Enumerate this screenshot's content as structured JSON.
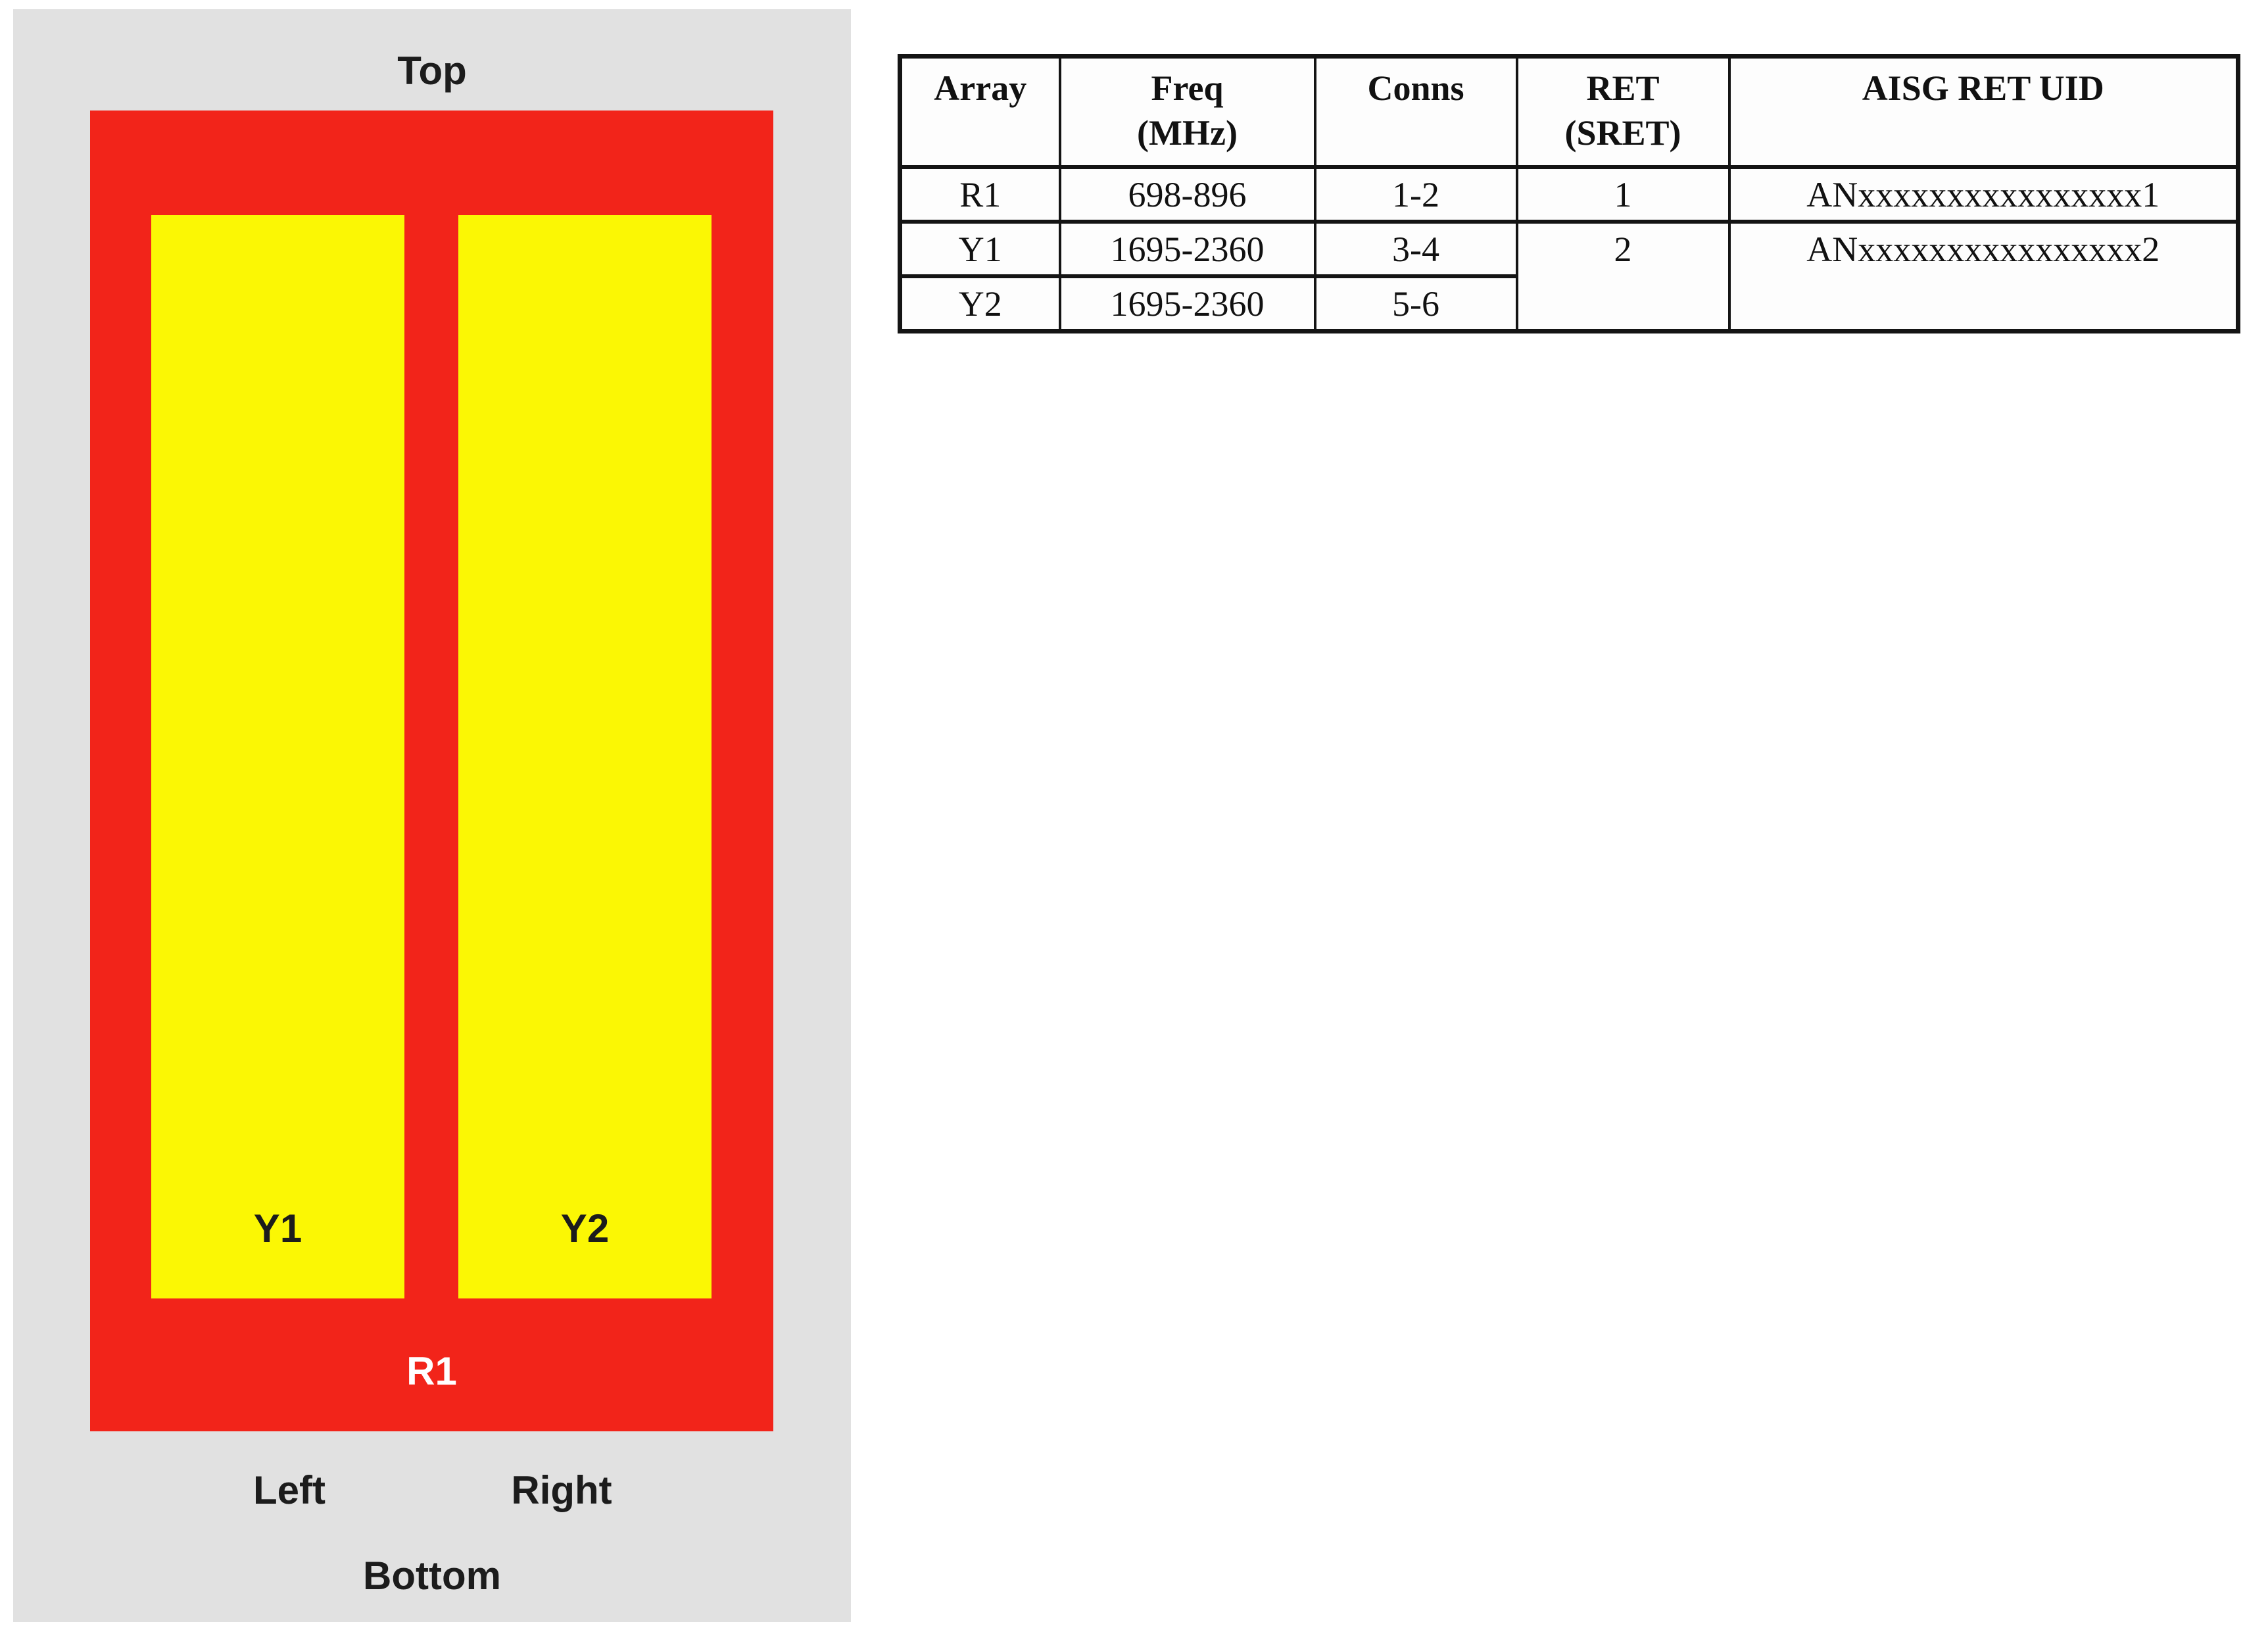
{
  "diagram": {
    "labels": {
      "top": "Top",
      "left": "Left",
      "right": "Right",
      "bottom": "Bottom",
      "red_array": "R1",
      "yellow_array_1": "Y1",
      "yellow_array_2": "Y2"
    },
    "colors": {
      "panel_background": "#e1e1e1",
      "red_array_fill": "#f2241a",
      "yellow_array_fill": "#fbf704",
      "dark_label": "#1c1c1c",
      "light_label": "#ffffff"
    }
  },
  "table": {
    "headers": {
      "array": "Array",
      "freq_line1": "Freq",
      "freq_line2": "(MHz)",
      "conns": "Conns",
      "ret_line1": "RET",
      "ret_line2": "(SRET)",
      "uid": "AISG RET UID"
    },
    "rows": [
      {
        "array": "R1",
        "freq": "698-896",
        "conns": "1-2",
        "ret": "1",
        "uid": "ANxxxxxxxxxxxxxxxx1"
      },
      {
        "array": "Y1",
        "freq": "1695-2360",
        "conns": "3-4",
        "ret": "2",
        "uid": "ANxxxxxxxxxxxxxxxx2"
      },
      {
        "array": "Y2",
        "freq": "1695-2360",
        "conns": "5-6"
      }
    ]
  }
}
